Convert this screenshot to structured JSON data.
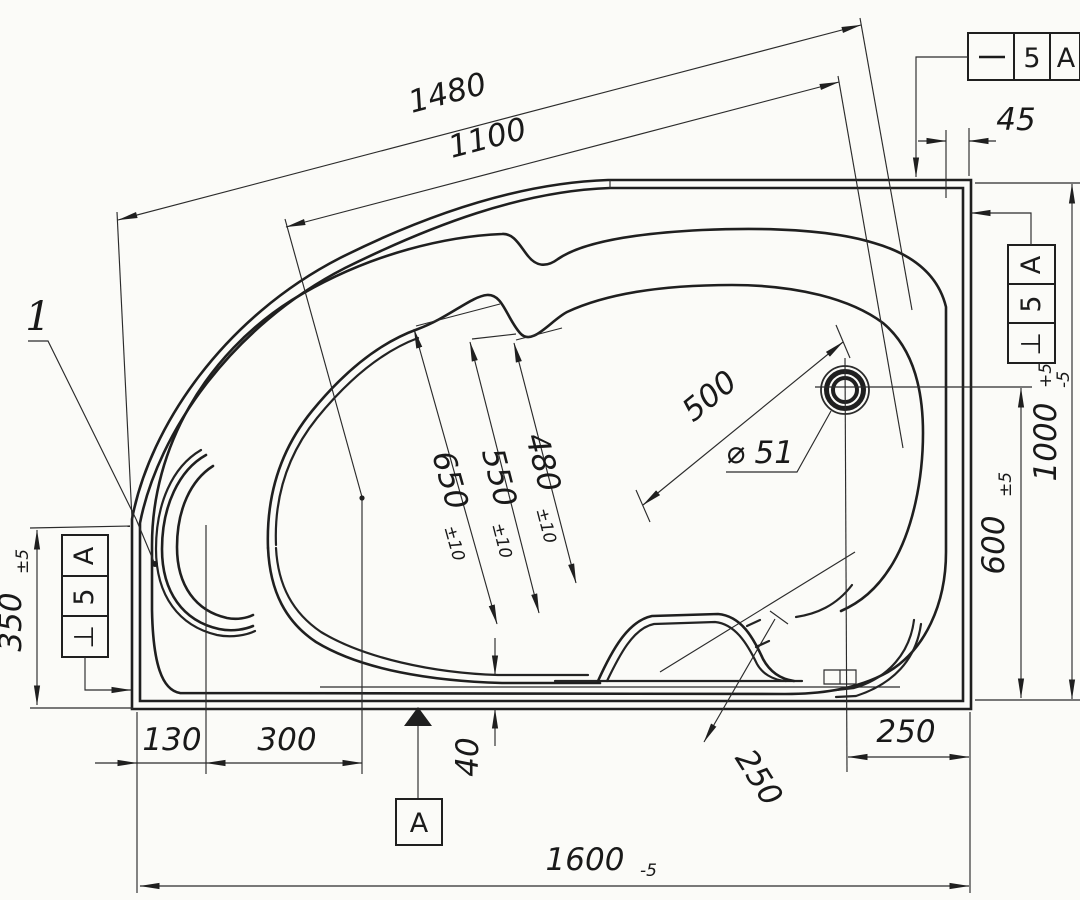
{
  "drawing": {
    "part_label": "1",
    "datum_label": "A",
    "tolerance_frames": {
      "top_right": {
        "symbol_name": "straightness",
        "symbol": "—",
        "value": "5",
        "datum": "A"
      },
      "right": {
        "symbol_name": "perpendicularity",
        "symbol": "⊥",
        "value": "5",
        "datum": "A"
      },
      "left": {
        "symbol_name": "perpendicularity",
        "symbol": "⊥",
        "value": "5",
        "datum": "A"
      }
    },
    "dimensions": {
      "overall_width": {
        "value": "1600",
        "tolerance": "-5"
      },
      "top_outer": {
        "value": "1480"
      },
      "top_inner": {
        "value": "1100"
      },
      "rim_right": {
        "value": "45"
      },
      "height_overall": {
        "value": "1000",
        "tol_plus": "+5",
        "tol_minus": "-5"
      },
      "drain_height": {
        "value": "600",
        "tolerance": "±5"
      },
      "left_height": {
        "value": "350",
        "tolerance": "±5"
      },
      "bowl_650": {
        "value": "650",
        "tolerance": "±10"
      },
      "bowl_550": {
        "value": "550",
        "tolerance": "±10"
      },
      "bowl_480": {
        "value": "480",
        "tolerance": "±10"
      },
      "drain_diagonal": {
        "value": "500"
      },
      "drain_diameter": {
        "value": "⌀ 51"
      },
      "bottom_130": {
        "value": "130"
      },
      "bottom_300": {
        "value": "300"
      },
      "apron_40": {
        "value": "40"
      },
      "seat_250": {
        "value": "250"
      },
      "drain_right_250": {
        "value": "250"
      }
    }
  }
}
